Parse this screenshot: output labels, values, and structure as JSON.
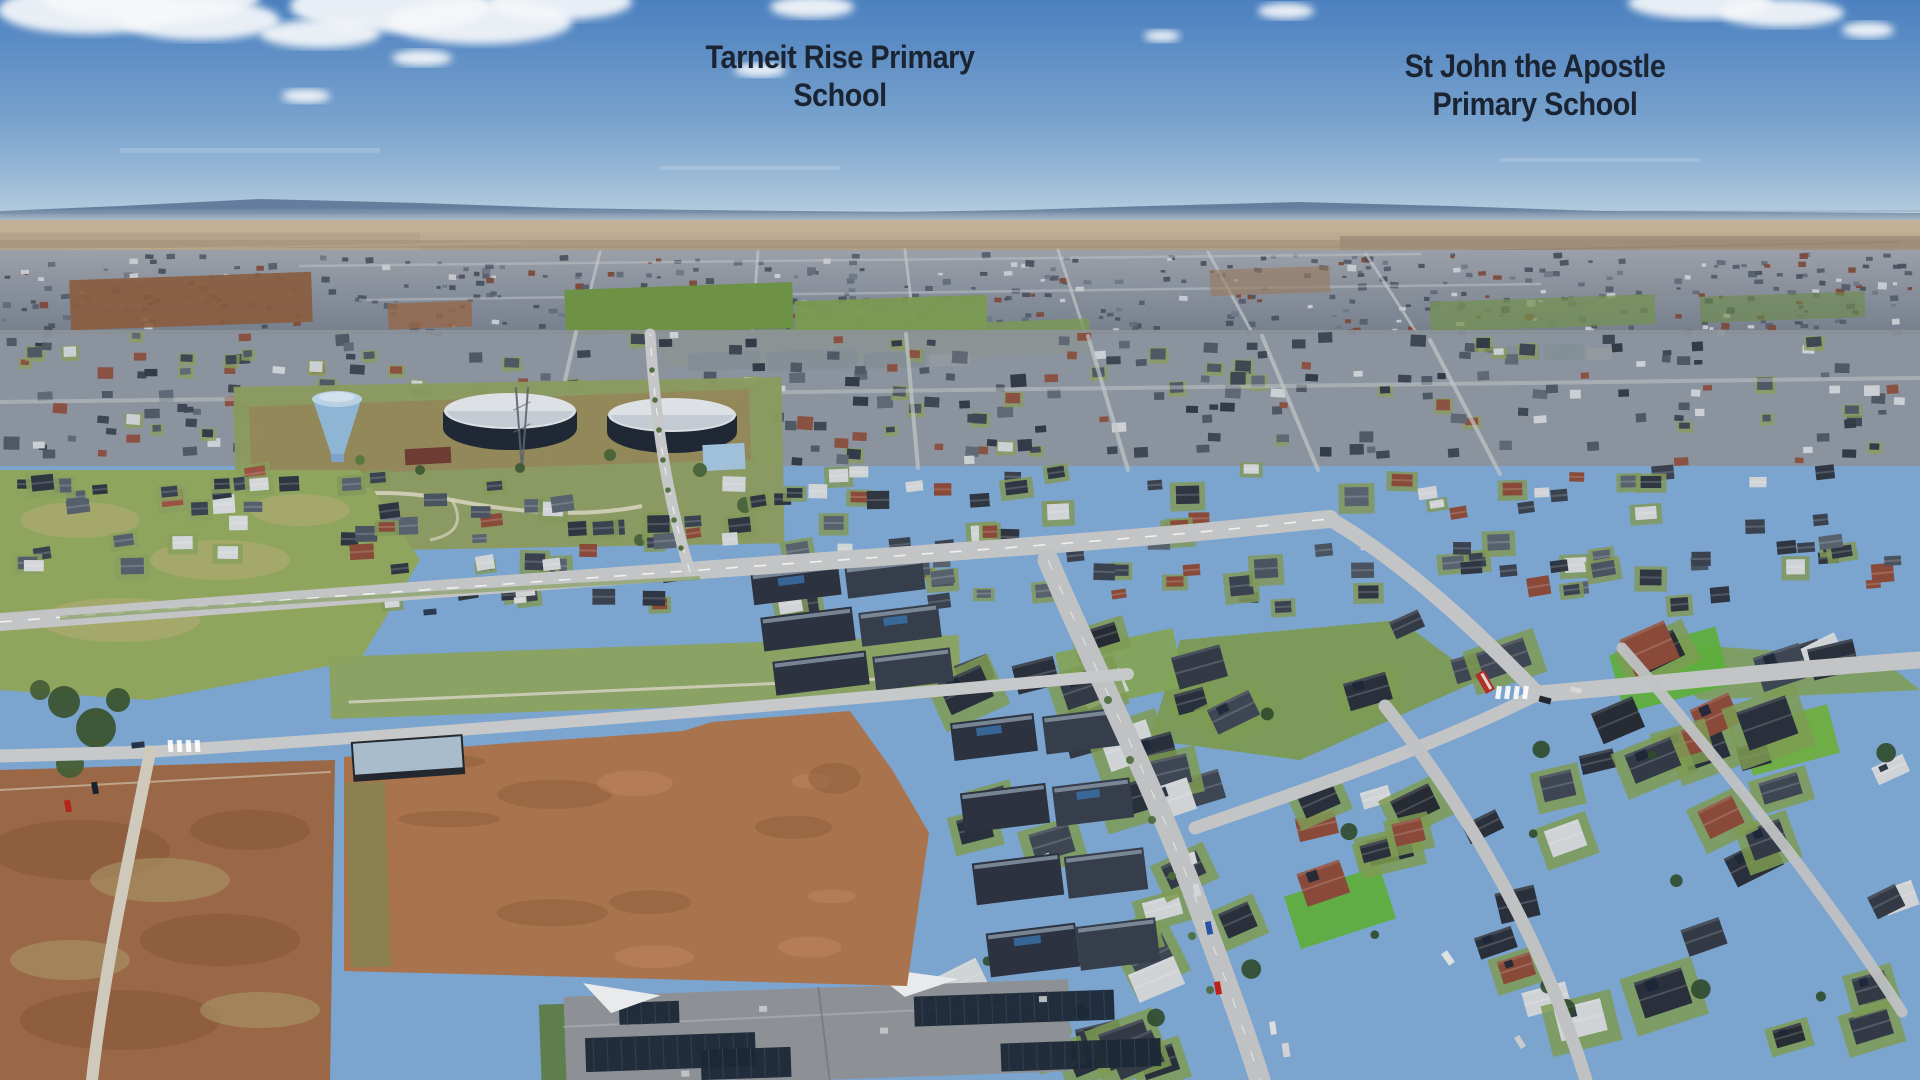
{
  "annotations": {
    "tarneit_rise": {
      "line1": "Tarneit Rise Primary",
      "line2": "School",
      "arrow": {
        "x": 840,
        "top": 118,
        "tip": 362,
        "stem_w": 11,
        "head_w": 30,
        "head_len": 30
      }
    },
    "st_john": {
      "line1": "St John the Apostle",
      "line2": "Primary School",
      "arrow": {
        "x": 1542,
        "top": 124,
        "tip": 352,
        "stem_w": 11,
        "head_w": 30,
        "head_len": 30
      }
    }
  },
  "site_outline": {
    "color": "#ee1409",
    "stroke_width": 7,
    "points": [
      [
        344,
        757
      ],
      [
        460,
        747
      ],
      [
        510,
        743
      ],
      [
        600,
        737
      ],
      [
        683,
        731
      ],
      [
        712,
        722
      ],
      [
        850,
        711
      ],
      [
        893,
        771
      ],
      [
        929,
        833
      ],
      [
        907,
        986
      ],
      [
        620,
        978
      ],
      [
        344,
        971
      ]
    ]
  },
  "palette": {
    "sky_top": "#4b80bf",
    "sky_mid": "#7ba4ce",
    "sky_horizon": "#bed2e0",
    "hills": "#5d7596",
    "plain": "#b49e85",
    "distant_suburb": "#848b97",
    "suburb_roof_dark": "#3a4250",
    "grass": "#7e9a50",
    "dry_grass": "#ac9a6a",
    "dirt": "#a9734e",
    "road": "#c2c4c5",
    "site_roof": "#a9bccb",
    "site_wall": "#23282e",
    "water_tower_blue": "#8fb5d5",
    "tank_dark": "#1f2834",
    "label_text": "#1b2433",
    "arrow_fill": "#fcfcf4",
    "arrow_stroke": "#999f9f"
  }
}
